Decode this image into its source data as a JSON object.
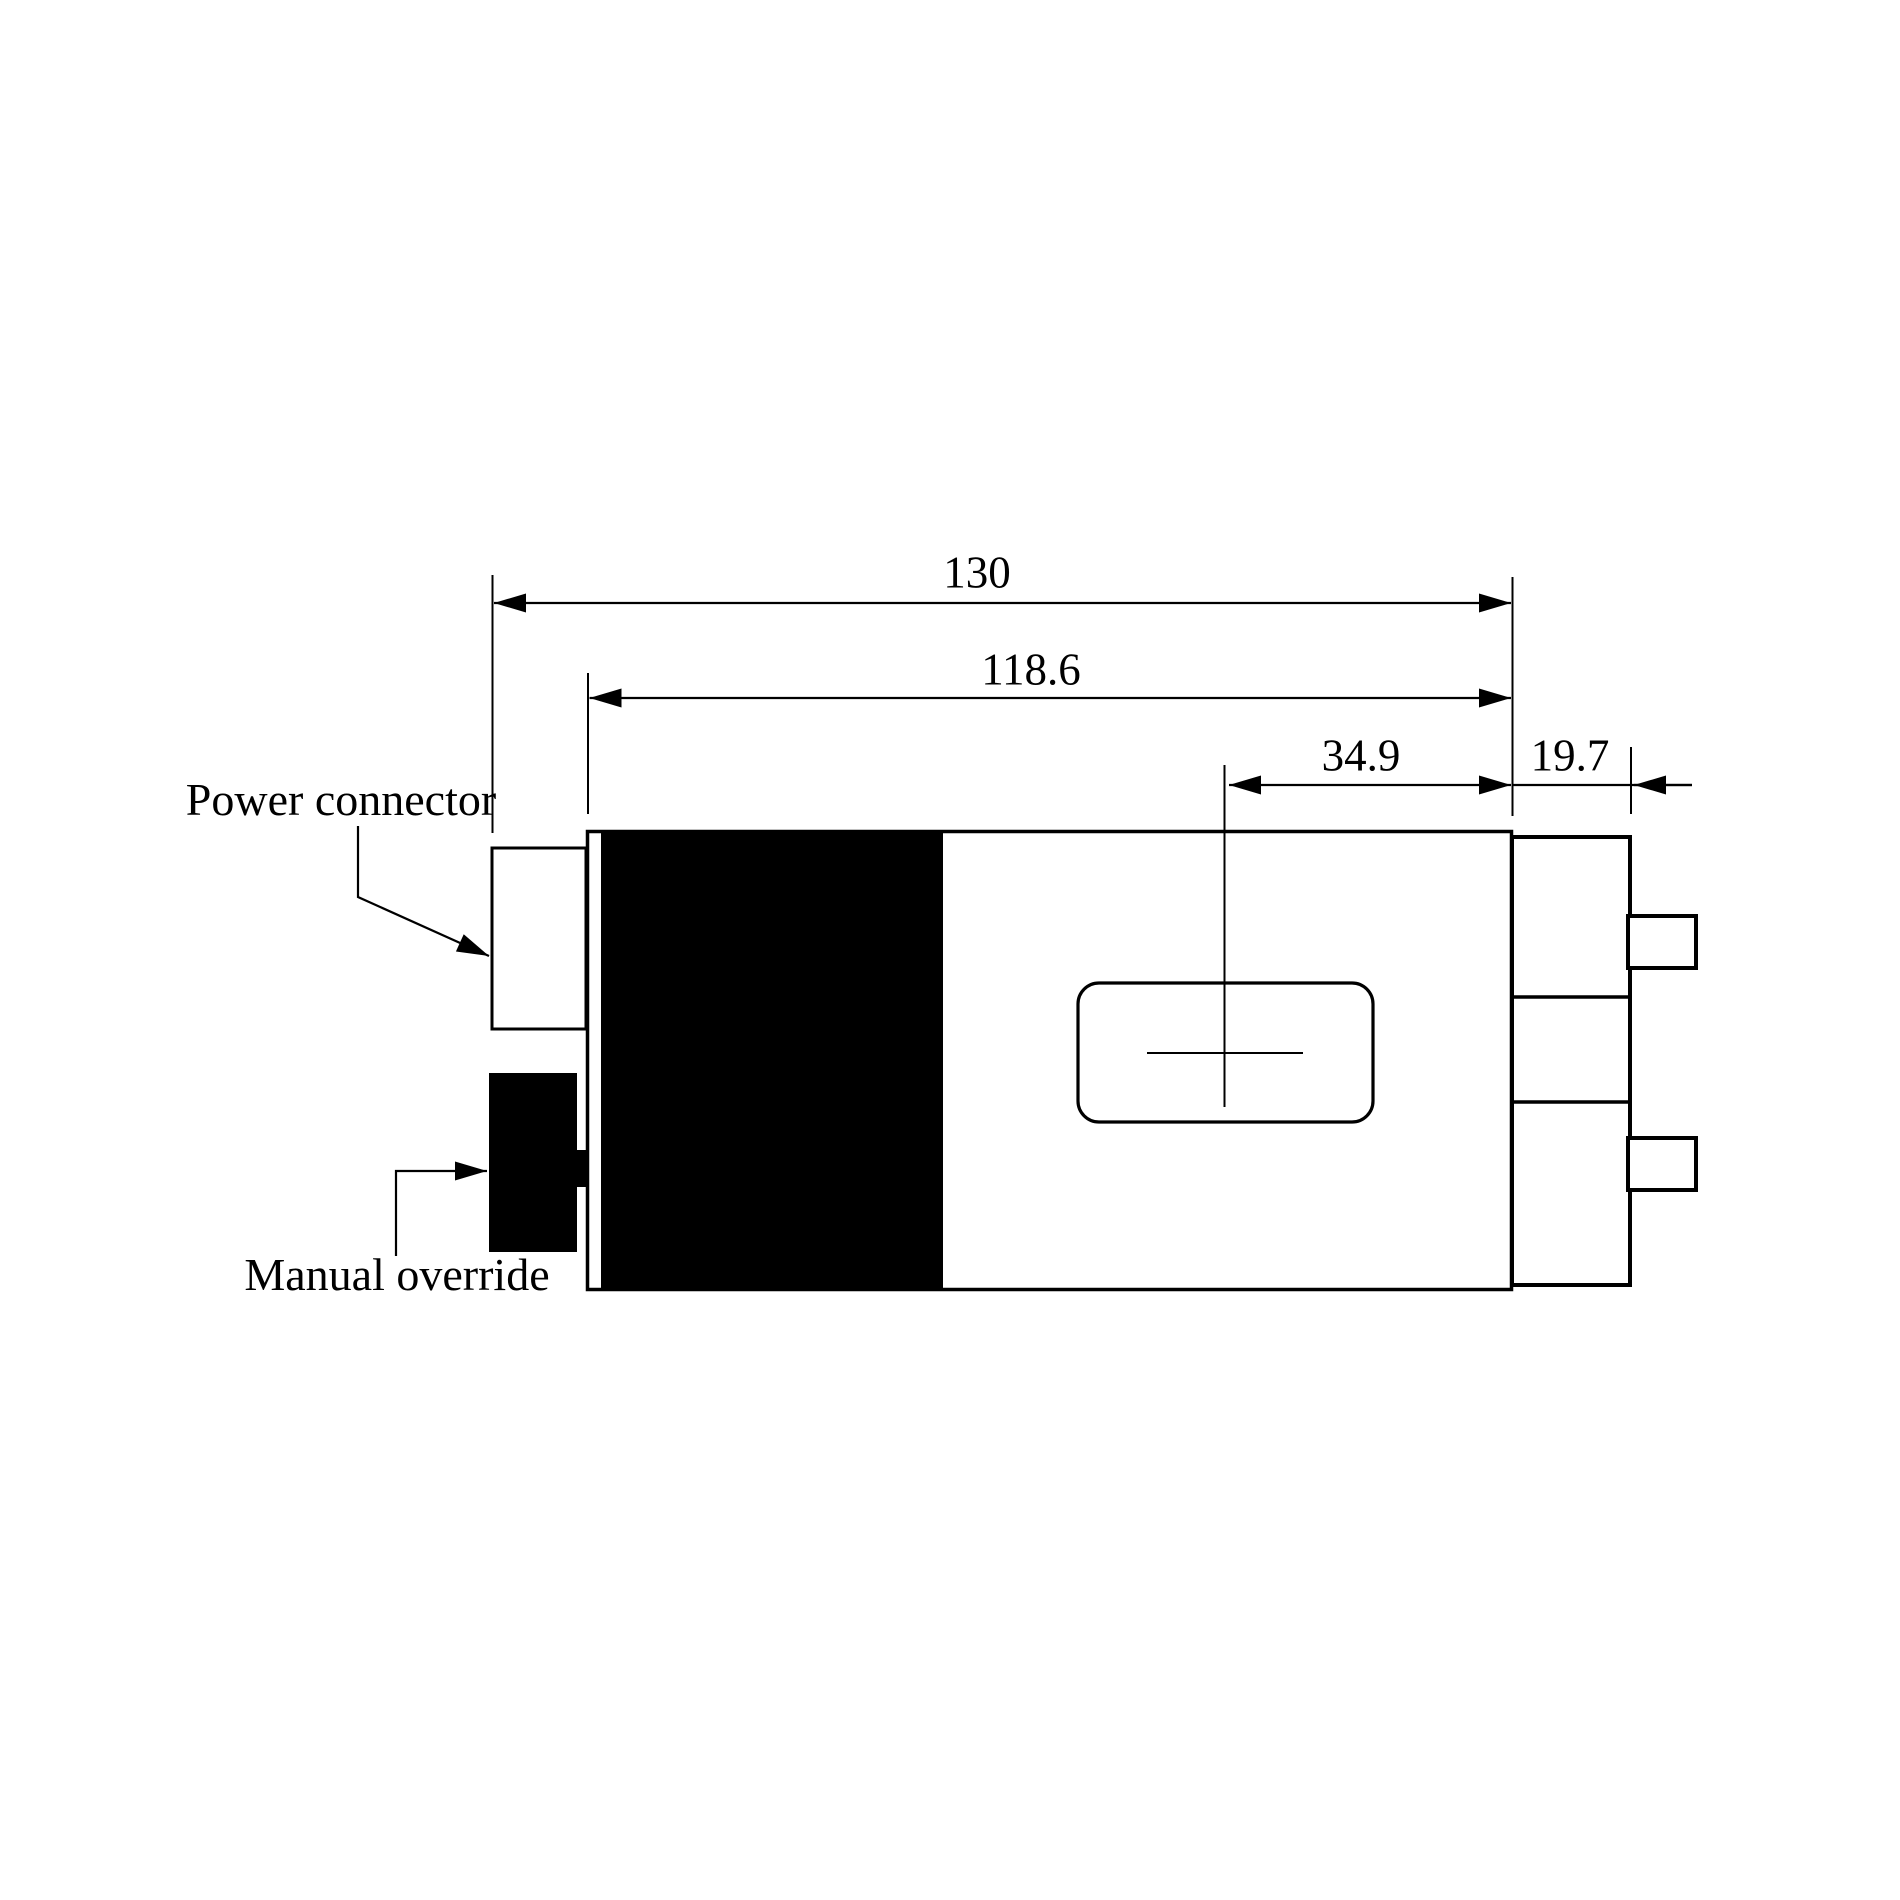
{
  "figure": {
    "type": "engineering-dimension-drawing",
    "view": "actuator-side-view",
    "background_color": "#ffffff",
    "line_color": "#000000",
    "fill_color": "#000000"
  },
  "labels": {
    "power_connector": "Power connector",
    "manual_override": "Manual override"
  },
  "dimensions": {
    "overall_length": "130",
    "body_length": "118.6",
    "window_center_offset": "34.9",
    "rear_section_length": "19.7"
  }
}
